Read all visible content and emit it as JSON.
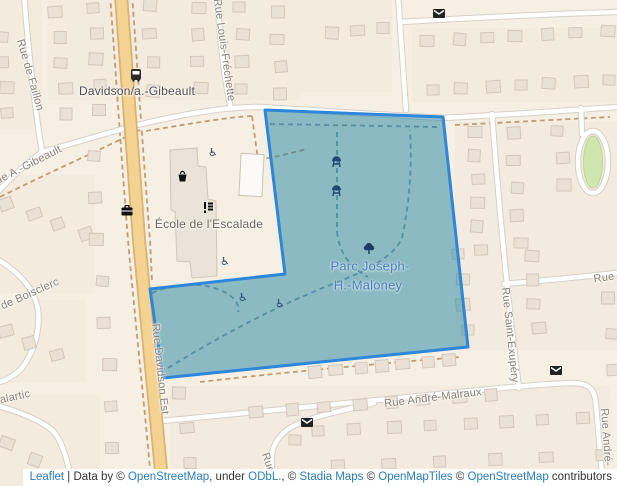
{
  "map_title": "Parc Joseph-H.-Maloney area map",
  "streets": {
    "faillon": "Rue de Faillon",
    "a_gibeault": "Rue A.-Gibeault",
    "louis_frechette": "Rue Louis-Fréchette",
    "davidson_est": "Rue Davidson Est",
    "boisclerc": "de Boisclerc",
    "malartic": "alartic",
    "andre_malraux": "Rue André-Malraux",
    "saint_exupery": "Rue Saint-Exupéry",
    "rue_right": "Rue",
    "andre": "Rue André-",
    "rue_bottom": "Rue"
  },
  "labels": {
    "transit_stop": "Davidson/a.-Gibeault",
    "school": "École de l'Escalade",
    "park_line1": "Parc Joseph-",
    "park_line2": "H.-Maloney"
  },
  "icons": [
    "bus-stop-icon",
    "mail-icon",
    "bbq-grill-icon",
    "tree-icon",
    "wheelchair-icon",
    "waste-basket-icon",
    "school-icon",
    "briefcase-icon"
  ],
  "colors": {
    "background": "#f6f0e4",
    "park_fill": "rgba(26,127,158,0.48)",
    "park_stroke": "#2e86d8",
    "park_label": "#4a80b5",
    "street_label": "#8a8177",
    "major_road": "#f3d292",
    "link": "#2b7cba"
  },
  "attribution": {
    "leaflet": "Leaflet",
    "sep": " | ",
    "data_by": "Data by © ",
    "osm1": "OpenStreetMap",
    "under": ", under ",
    "odbl": "ODbL.",
    "comma_c": ", © ",
    "stadia": "Stadia Maps",
    "c1": " © ",
    "openmaptiles": "OpenMapTiles",
    "c2": " © ",
    "osm2": "OpenStreetMap",
    "contributors": " contributors"
  }
}
